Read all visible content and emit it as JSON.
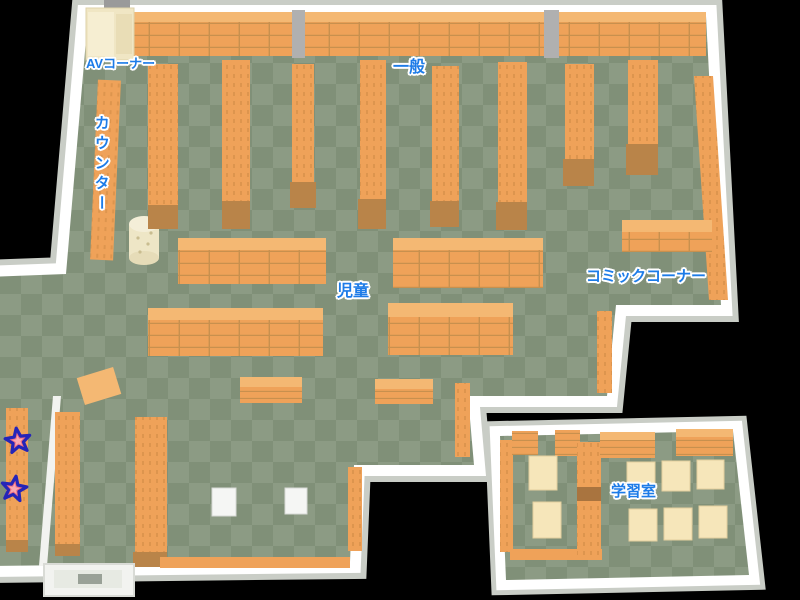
{
  "scene": {
    "type": "library-floor-map",
    "description": "Top-down isometric map of a library floor with labeled areas"
  },
  "labels": {
    "av_corner": "AVコーナー",
    "general": "一般",
    "counter": "カウンター",
    "children": "児童",
    "comic_corner": "コミックコーナー",
    "study_room": "学習室"
  },
  "markers": {
    "stars": [
      {
        "id": "star-1",
        "area": "left-bottom-shelf-upper"
      },
      {
        "id": "star-2",
        "area": "left-bottom-shelf-lower"
      }
    ]
  },
  "theme": {
    "colors": {
      "bg": "#000000",
      "floor-light": "#8c9b84",
      "floor-dark": "#809078",
      "wall": "#ffffff",
      "wall-shade": "#c9cdc6",
      "shelf": "#efa259",
      "shelf-top": "#f4b873",
      "shelf-cap": "#b98449",
      "shelf-grid": "#c8904e",
      "desk": "#f6e6ba",
      "av-unit": "#f0e6c4",
      "pillar": "#b0b0b0",
      "cylinder": "#f2ecd2",
      "label-blue": "#1d7ce8",
      "star-fill": "#ee6e80",
      "star-stroke": "#2525b8"
    }
  }
}
